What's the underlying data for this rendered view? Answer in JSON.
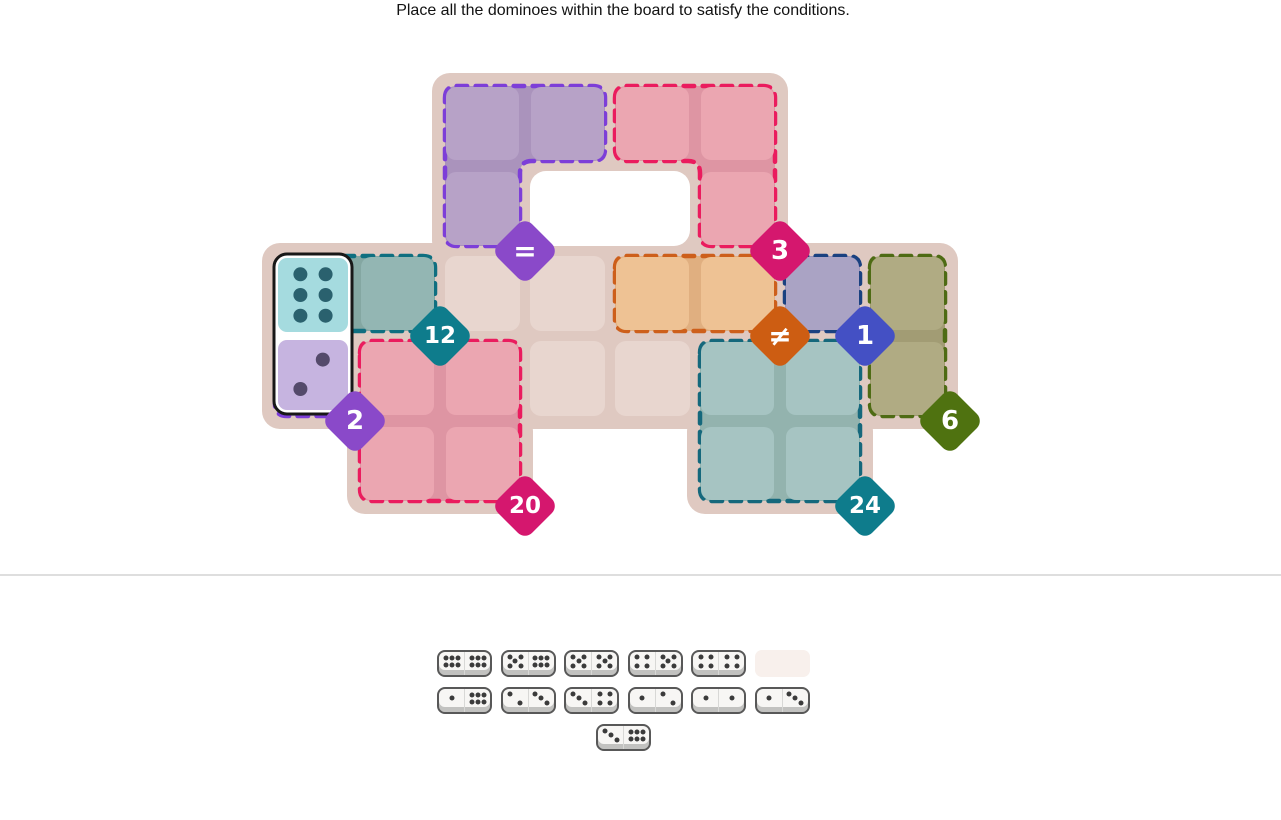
{
  "title": "Place all the dominoes within the board to satisfy the conditions.",
  "board": {
    "base_color": "#dfc9c1",
    "plain_cell_color": "#e8d6cf",
    "hole_color": "#ffffff",
    "base_blocks": [
      {
        "c1": 2,
        "r1": 0,
        "c2": 5,
        "r2": 1
      },
      {
        "c1": 0,
        "r1": 2,
        "c2": 7,
        "r2": 3
      },
      {
        "c1": 1,
        "r1": 4,
        "c2": 2,
        "r2": 4
      },
      {
        "c1": 5,
        "r1": 4,
        "c2": 6,
        "r2": 4
      }
    ],
    "plain_cells": [
      [
        2,
        2
      ],
      [
        3,
        2
      ],
      [
        3,
        3
      ],
      [
        4,
        3
      ]
    ],
    "holes": [
      [
        3,
        1
      ],
      [
        4,
        1
      ]
    ],
    "regions": [
      {
        "id": "equals",
        "condition": "=",
        "cells": [
          [
            2,
            0
          ],
          [
            3,
            0
          ],
          [
            2,
            1
          ]
        ],
        "cell_color": "#b7a2c7",
        "seam_color": "#aa93bc",
        "border_color": "#7d3ed8",
        "badge_color": "#8a49c9",
        "badge_corner": [
          3,
          2
        ],
        "symbol": true
      },
      {
        "id": "three",
        "condition": "3",
        "cells": [
          [
            4,
            0
          ],
          [
            5,
            0
          ],
          [
            5,
            1
          ]
        ],
        "cell_color": "#eba6b1",
        "seam_color": "#de95a3",
        "border_color": "#ea1c5e",
        "badge_color": "#d5176e",
        "badge_corner": [
          6,
          2
        ],
        "symbol": false
      },
      {
        "id": "twelve",
        "condition": "12",
        "cells": [
          [
            0,
            2
          ],
          [
            1,
            2
          ]
        ],
        "cell_color": "#93b6b3",
        "seam_color": "#84a7a2",
        "border_color": "#0f6f80",
        "badge_color": "#0e7c8c",
        "badge_corner": [
          2,
          3
        ],
        "symbol": false
      },
      {
        "id": "not-equal",
        "condition": "≠",
        "cells": [
          [
            4,
            2
          ],
          [
            5,
            2
          ]
        ],
        "cell_color": "#eec294",
        "seam_color": "#e0af80",
        "border_color": "#cd5f1b",
        "badge_color": "#cd5d12",
        "badge_corner": [
          6,
          3
        ],
        "symbol": true
      },
      {
        "id": "one",
        "condition": "1",
        "cells": [
          [
            6,
            2
          ]
        ],
        "cell_color": "#aaa3c4",
        "seam_color": "#9c94b8",
        "border_color": "#1a4180",
        "badge_color": "#4450c4",
        "badge_corner": [
          7,
          3
        ],
        "symbol": false
      },
      {
        "id": "two",
        "condition": "2",
        "cells": [
          [
            0,
            3
          ]
        ],
        "cell_color": "#c6b4e0",
        "seam_color": "#b7a3d4",
        "border_color": "#7d3ed8",
        "badge_color": "#8a49c9",
        "badge_corner": [
          1,
          4
        ],
        "symbol": false
      },
      {
        "id": "six",
        "condition": "6",
        "cells": [
          [
            7,
            2
          ],
          [
            7,
            3
          ]
        ],
        "cell_color": "#b0ab83",
        "seam_color": "#a29c74",
        "border_color": "#4e6b14",
        "badge_color": "#4f7210",
        "badge_corner": [
          8,
          4
        ],
        "symbol": false
      },
      {
        "id": "twenty",
        "condition": "20",
        "cells": [
          [
            1,
            3
          ],
          [
            2,
            3
          ],
          [
            1,
            4
          ],
          [
            2,
            4
          ]
        ],
        "cell_color": "#eba6b1",
        "seam_color": "#de95a3",
        "border_color": "#ea1c5e",
        "badge_color": "#d5176e",
        "badge_corner": [
          3,
          5
        ],
        "symbol": false
      },
      {
        "id": "twentyfour",
        "condition": "24",
        "cells": [
          [
            5,
            3
          ],
          [
            6,
            3
          ],
          [
            5,
            4
          ],
          [
            6,
            4
          ]
        ],
        "cell_color": "#a6c4c2",
        "seam_color": "#93b3ae",
        "border_color": "#15687c",
        "badge_color": "#0e7c8c",
        "badge_corner": [
          7,
          5
        ],
        "symbol": false
      }
    ],
    "placed_domino": {
      "values": [
        6,
        2
      ],
      "cells": [
        [
          0,
          2
        ],
        [
          0,
          3
        ]
      ],
      "half_colors": [
        "#a5dbdf",
        "#c6b4e0"
      ],
      "pip_colors": [
        "#2a616e",
        "#544a6b"
      ],
      "outline_color": "#181818"
    }
  },
  "tray": {
    "slot_color": "#f8f0ec",
    "rows": [
      [
        {
          "pips": [
            6,
            6
          ]
        },
        {
          "pips": [
            5,
            6
          ]
        },
        {
          "pips": [
            5,
            5
          ]
        },
        {
          "pips": [
            4,
            5
          ]
        },
        {
          "pips": [
            4,
            4
          ]
        },
        {
          "empty": true
        }
      ],
      [
        {
          "pips": [
            1,
            6
          ]
        },
        {
          "pips": [
            2,
            3
          ]
        },
        {
          "pips": [
            3,
            4
          ]
        },
        {
          "pips": [
            1,
            2
          ]
        },
        {
          "pips": [
            1,
            1
          ]
        },
        {
          "pips": [
            1,
            3
          ]
        }
      ],
      [
        {
          "pips": [
            3,
            6
          ]
        }
      ]
    ]
  }
}
